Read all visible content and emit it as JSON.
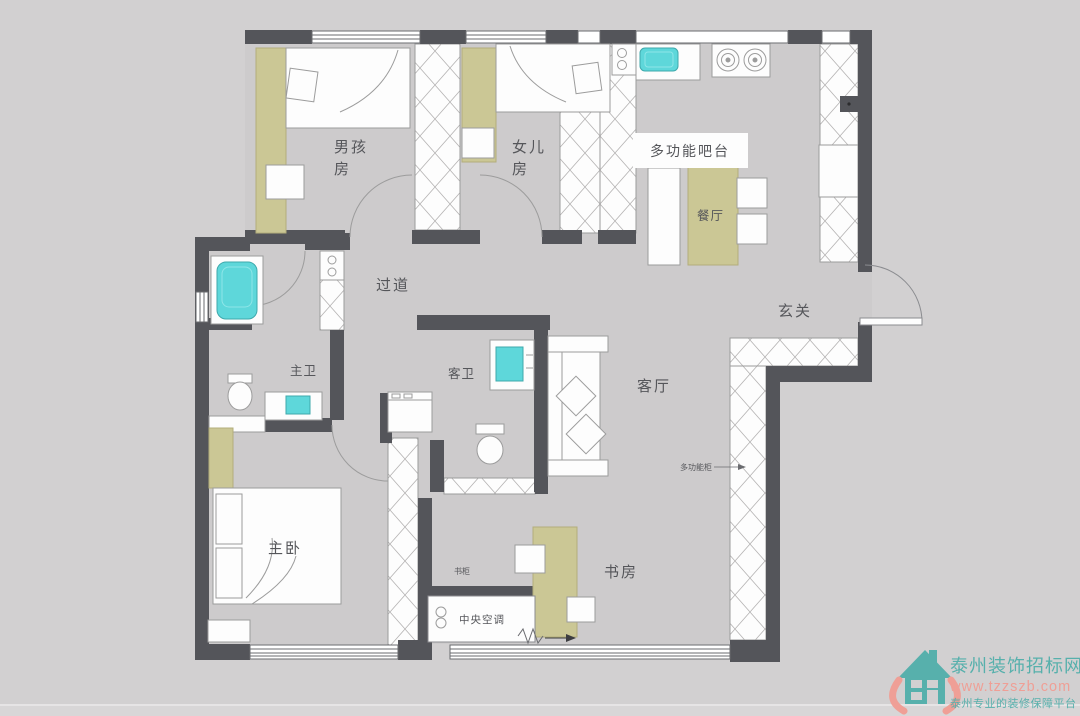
{
  "plan": {
    "rooms": {
      "boys_room": {
        "line1": "男孩",
        "line2": "房"
      },
      "daughters_room": {
        "line1": "女儿",
        "line2": "房"
      },
      "hallway": "过道",
      "master_bath": "主卫",
      "guest_bath": "客卫",
      "living_room": "客厅",
      "master_bedroom": "主卧",
      "study": "书房",
      "dining": "餐厅",
      "entry": "玄关",
      "bar": "多功能吧台"
    },
    "annotations": {
      "central_ac": "中央空调",
      "bookcase": "书柜",
      "multi_cabinet": "多功能柜"
    }
  },
  "watermark": {
    "site_name": "泰州装饰招标网",
    "site_url": "www.tzzszb.com",
    "tagline": "泰州专业的装修保障平台"
  },
  "colors": {
    "background": "#d2d0d1",
    "floor": "#cdcbcc",
    "wall": "#54555a",
    "accent_green": "#cbc795",
    "fixture_cyan": "#5ed7da",
    "furniture_outline": "#9c9c9c",
    "watermark_teal": "#57b0ac",
    "watermark_salmon": "#ef9f96"
  }
}
